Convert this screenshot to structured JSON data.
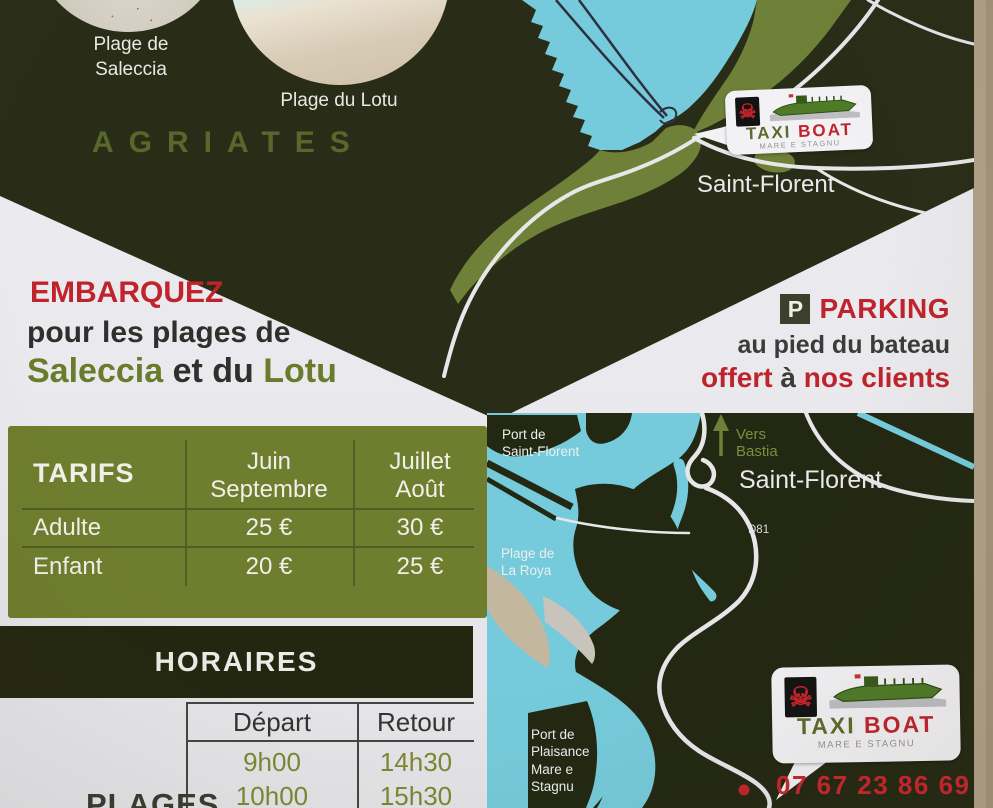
{
  "top": {
    "saleccia_label": "Plage de\nSaleccia",
    "lotu_label": "Plage du Lotu",
    "region": "AGRIATES",
    "town": "Saint-Florent"
  },
  "logo": {
    "taxi": "TAXI",
    "boat": "BOAT",
    "tagline": "MARE E STAGNU",
    "skull_glyph": "☠"
  },
  "embark": {
    "title": "EMBARQUEZ",
    "line2": "pour les plages de",
    "saleccia": "Saleccia",
    "et_du": " et du ",
    "lotu": "Lotu"
  },
  "parking": {
    "p": "P",
    "title": "PARKING",
    "line2": "au pied du bateau",
    "offert": "offert",
    "a": " à ",
    "clients": "nos clients"
  },
  "tarifs": {
    "title": "TARIFS",
    "col_juin": "Juin\nSeptembre",
    "col_juillet": "Juillet\nAoût",
    "rows": [
      {
        "label": "Adulte",
        "juin": "25 €",
        "juillet": "30 €"
      },
      {
        "label": "Enfant",
        "juin": "20 €",
        "juillet": "25 €"
      }
    ]
  },
  "horaires": {
    "title": "HORAIRES",
    "col_depart": "Départ",
    "col_retour": "Retour",
    "rows": [
      {
        "depart": "9h00",
        "retour": "14h30"
      },
      {
        "depart": "10h00",
        "retour": "15h30"
      }
    ],
    "row_label": "PLAGES"
  },
  "map": {
    "port_sf": "Port de\nSaint-Florent",
    "vers_bastia": "Vers\nBastia",
    "town": "Saint-Florent",
    "road": "D81",
    "la_roya": "Plage de\nLa Roya",
    "plaisance": "Port de\nPlaisance\nMare e\nStagnu",
    "phone": "07 67 23 86 69"
  },
  "colors": {
    "dark_olive": "#292d17",
    "olive_green": "#6f7d2e",
    "map_green": "#6f8138",
    "water_cyan": "#75cbdb",
    "accent_red": "#bf232b",
    "wall_beige": "#b2a189"
  }
}
